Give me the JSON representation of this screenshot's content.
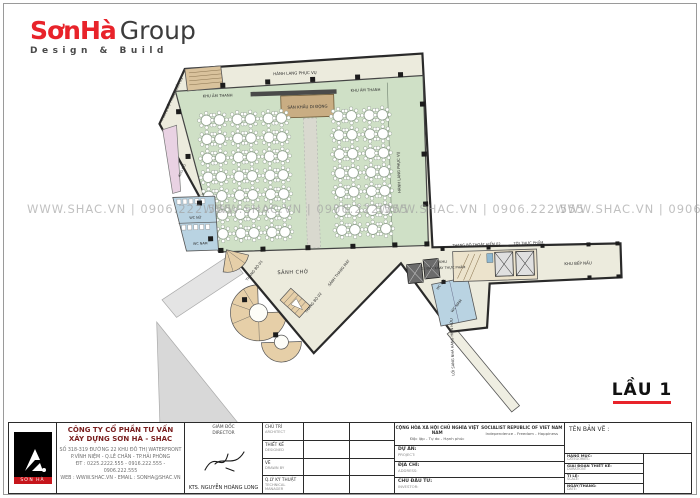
{
  "logo": {
    "brand": "SơnHà",
    "brand_suffix": "Group",
    "tagline": "Design & Build"
  },
  "watermark": {
    "text": "WWW.SHAC.VN  |  0906.222.555"
  },
  "floor_label": {
    "text": "LẦU 1"
  },
  "accent_colors": {
    "brand_red": "#e8232a",
    "hall_green": "#cfe0c6",
    "stage_tan": "#c9ad83",
    "wc_blue": "#b9d3e2"
  },
  "plan": {
    "labels": {
      "escape_stair_1": "THANG BỘ THOÁT HIỂM 01",
      "service_corridor_top": "HÀNH LANG PHỤC VỤ",
      "service_corridor_right": "HÀNH LANG PHỤC VỤ",
      "sound_area_left": "KHU ÂM THANH",
      "sound_area_right": "KHU ÂM THANH",
      "stage": "SÂN KHẤU DI ĐỘNG",
      "storage": "KHO ĐỒ",
      "wc_women_left": "WC NỮ",
      "wc_men_left": "WC NAM",
      "waiting_lobby": "SẢNH CHỜ",
      "stair_1": "THANG BỘ 01",
      "stair_2": "THANG BỘ 02",
      "elevator_lobby": "SẢNH THANG MÁY",
      "wc_women_right": "WC NỮ",
      "wc_men_right": "WC NAM",
      "escape_stair_2": "THANG BỘ THOÁT HIỂM 02",
      "food_lift": "TỜI THỰC PHẨM",
      "tray_area_line1": "KHU",
      "tray_area_line2": "XE ĐẨY KHAY THỰC PHẨM",
      "kitchen": "KHU BẾP NẤU",
      "passage_existing": "LỐI SANG NHÀ HÀNG HIỆN HỮU"
    },
    "tables": {
      "left_block": {
        "cols": 6,
        "rows": 7
      },
      "right_block": {
        "cols": 4,
        "rows": 7
      }
    }
  },
  "title_block": {
    "logo_text": "SƠN HÀ",
    "company_line1": "CÔNG TY CỔ PHẦN TƯ VẤN",
    "company_line2": "XÂY DỰNG SƠN HÀ - SHAC",
    "address_line1": "SỐ 318-319 ĐƯỜNG 22 KHU ĐÔ THỊ WATERFRONT",
    "address_line2": "P.VĨNH NIỆM - Q.LÊ CHÂN - TP.HẢI PHÒNG",
    "address_line3": "ĐT : 0225.2222.555 - 0916.222.555 - 0906.222.555",
    "address_line4": "WEB : WWW.SHAC.VN - EMAIL : SONHA@SHAC.VN",
    "director_vn": "GIÁM ĐỐC",
    "director_en": "DIRECTOR",
    "director_name": "KTS. NGUYỄN HOÀNG LONG",
    "rows": [
      {
        "vn": "CHỦ TRÌ",
        "en": "ARCHITECT"
      },
      {
        "vn": "THIẾT KẾ",
        "en": "DESIGNED"
      },
      {
        "vn": "VẼ",
        "en": "DRAWN BY"
      },
      {
        "vn": "Q.LÝ KỸ THUẬT",
        "en": "TECHNICAL MANAGER"
      }
    ],
    "motto_vn1": "CỘNG HÒA XÃ HỘI CHỦ NGHĨA VIỆT NAM",
    "motto_vn2": "Độc lập - Tự do - Hạnh phúc",
    "motto_en1": "SOCIALIST REPUBLIC OF VIET NAM",
    "motto_en2": "Independence - Freedom - Happiness",
    "project_vn": "DỰ ÁN:",
    "project_en": "PROJECT:",
    "address_vn": "ĐỊA CHỈ:",
    "address_en": "ADDRESS:",
    "investor_vn": "CHỦ ĐẦU TƯ:",
    "investor_en": "INVESTOR:",
    "drawing_name_label": "TÊN BẢN VẼ :",
    "meta_rows": [
      {
        "vn": "HẠNG MỤC:",
        "en": "CATEGORIES:"
      },
      {
        "vn": "GIAI ĐOẠN THIẾT KẾ:",
        "en": "DURATION:"
      },
      {
        "vn": "TỈ LỆ:",
        "en": "SCALE:"
      },
      {
        "vn": "NGÀY/THÁNG:",
        "en": "DATE:"
      }
    ]
  }
}
